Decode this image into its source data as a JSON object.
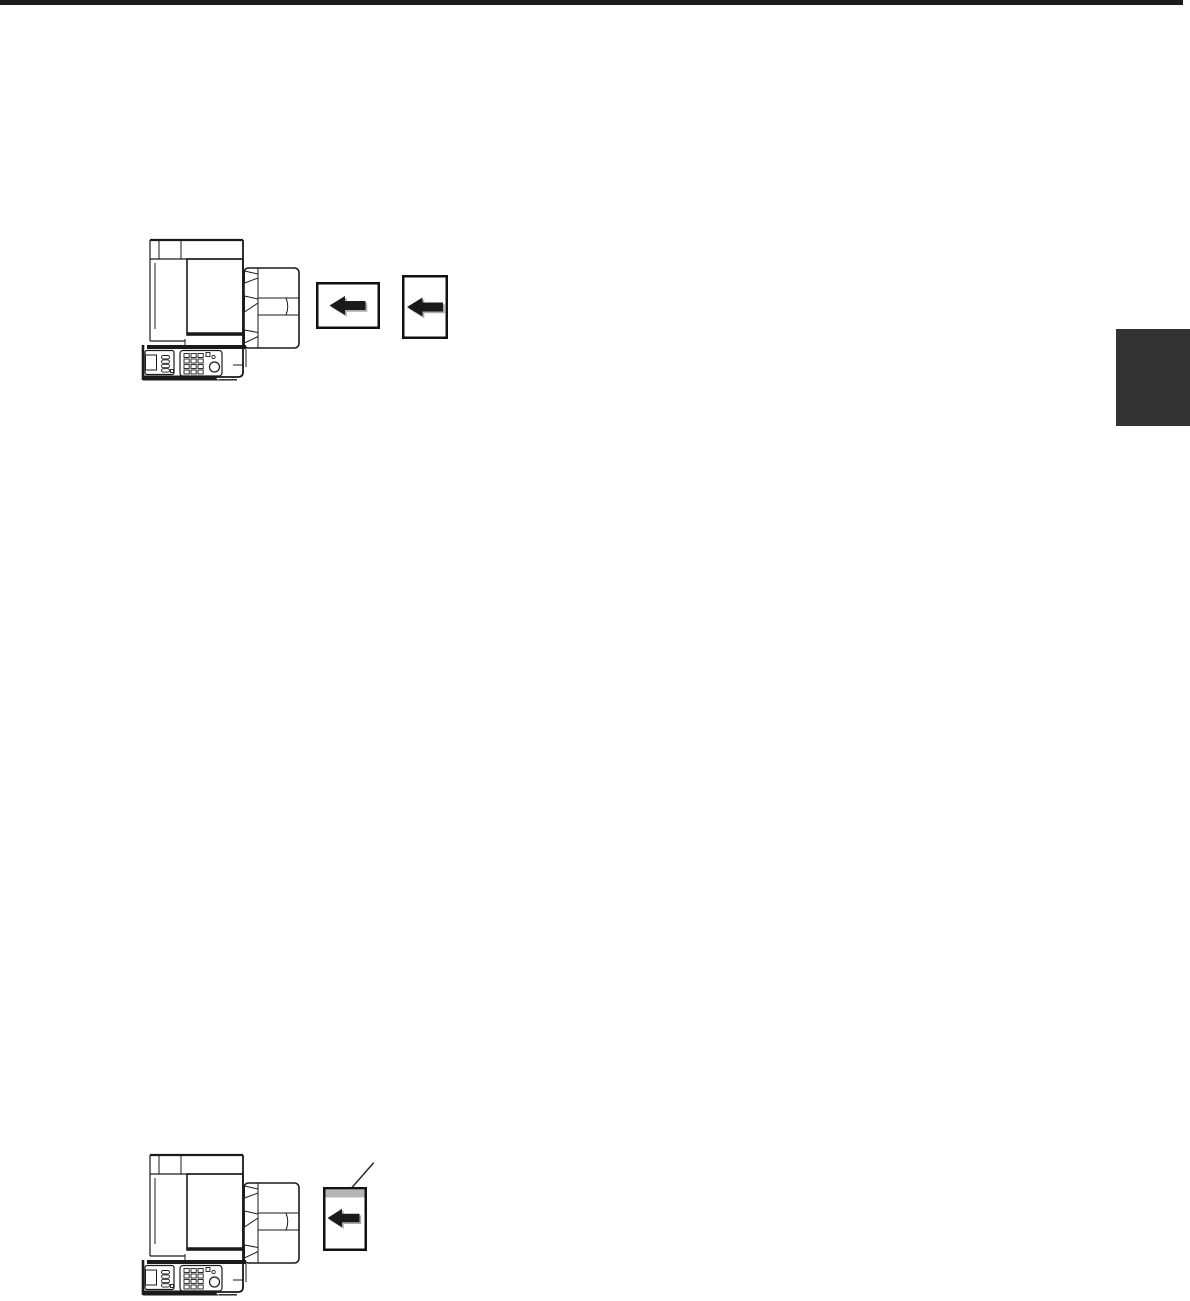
{
  "page": {
    "background": "#ffffff",
    "top_rule_color": "#1c1c1c",
    "side_tab_color": "#333333"
  },
  "colors": {
    "line_art": "#1a1a1a",
    "card_border": "#111111",
    "arrow_fill": "#1a1a1a",
    "arrow_shadow": "#ababab",
    "leading_edge_strip": "#b5b5b5",
    "callout_line": "#1a1a1a"
  },
  "figures": {
    "top": {
      "label": "printer-top-view-with-document-feeder",
      "cards": [
        {
          "orientation": "landscape",
          "arrow_direction": "left"
        },
        {
          "orientation": "portrait",
          "arrow_direction": "left"
        }
      ]
    },
    "bottom": {
      "label": "printer-top-view-with-document-feeder",
      "cards": [
        {
          "orientation": "portrait",
          "arrow_direction": "left",
          "leading_edge_highlighted": true
        }
      ]
    }
  }
}
